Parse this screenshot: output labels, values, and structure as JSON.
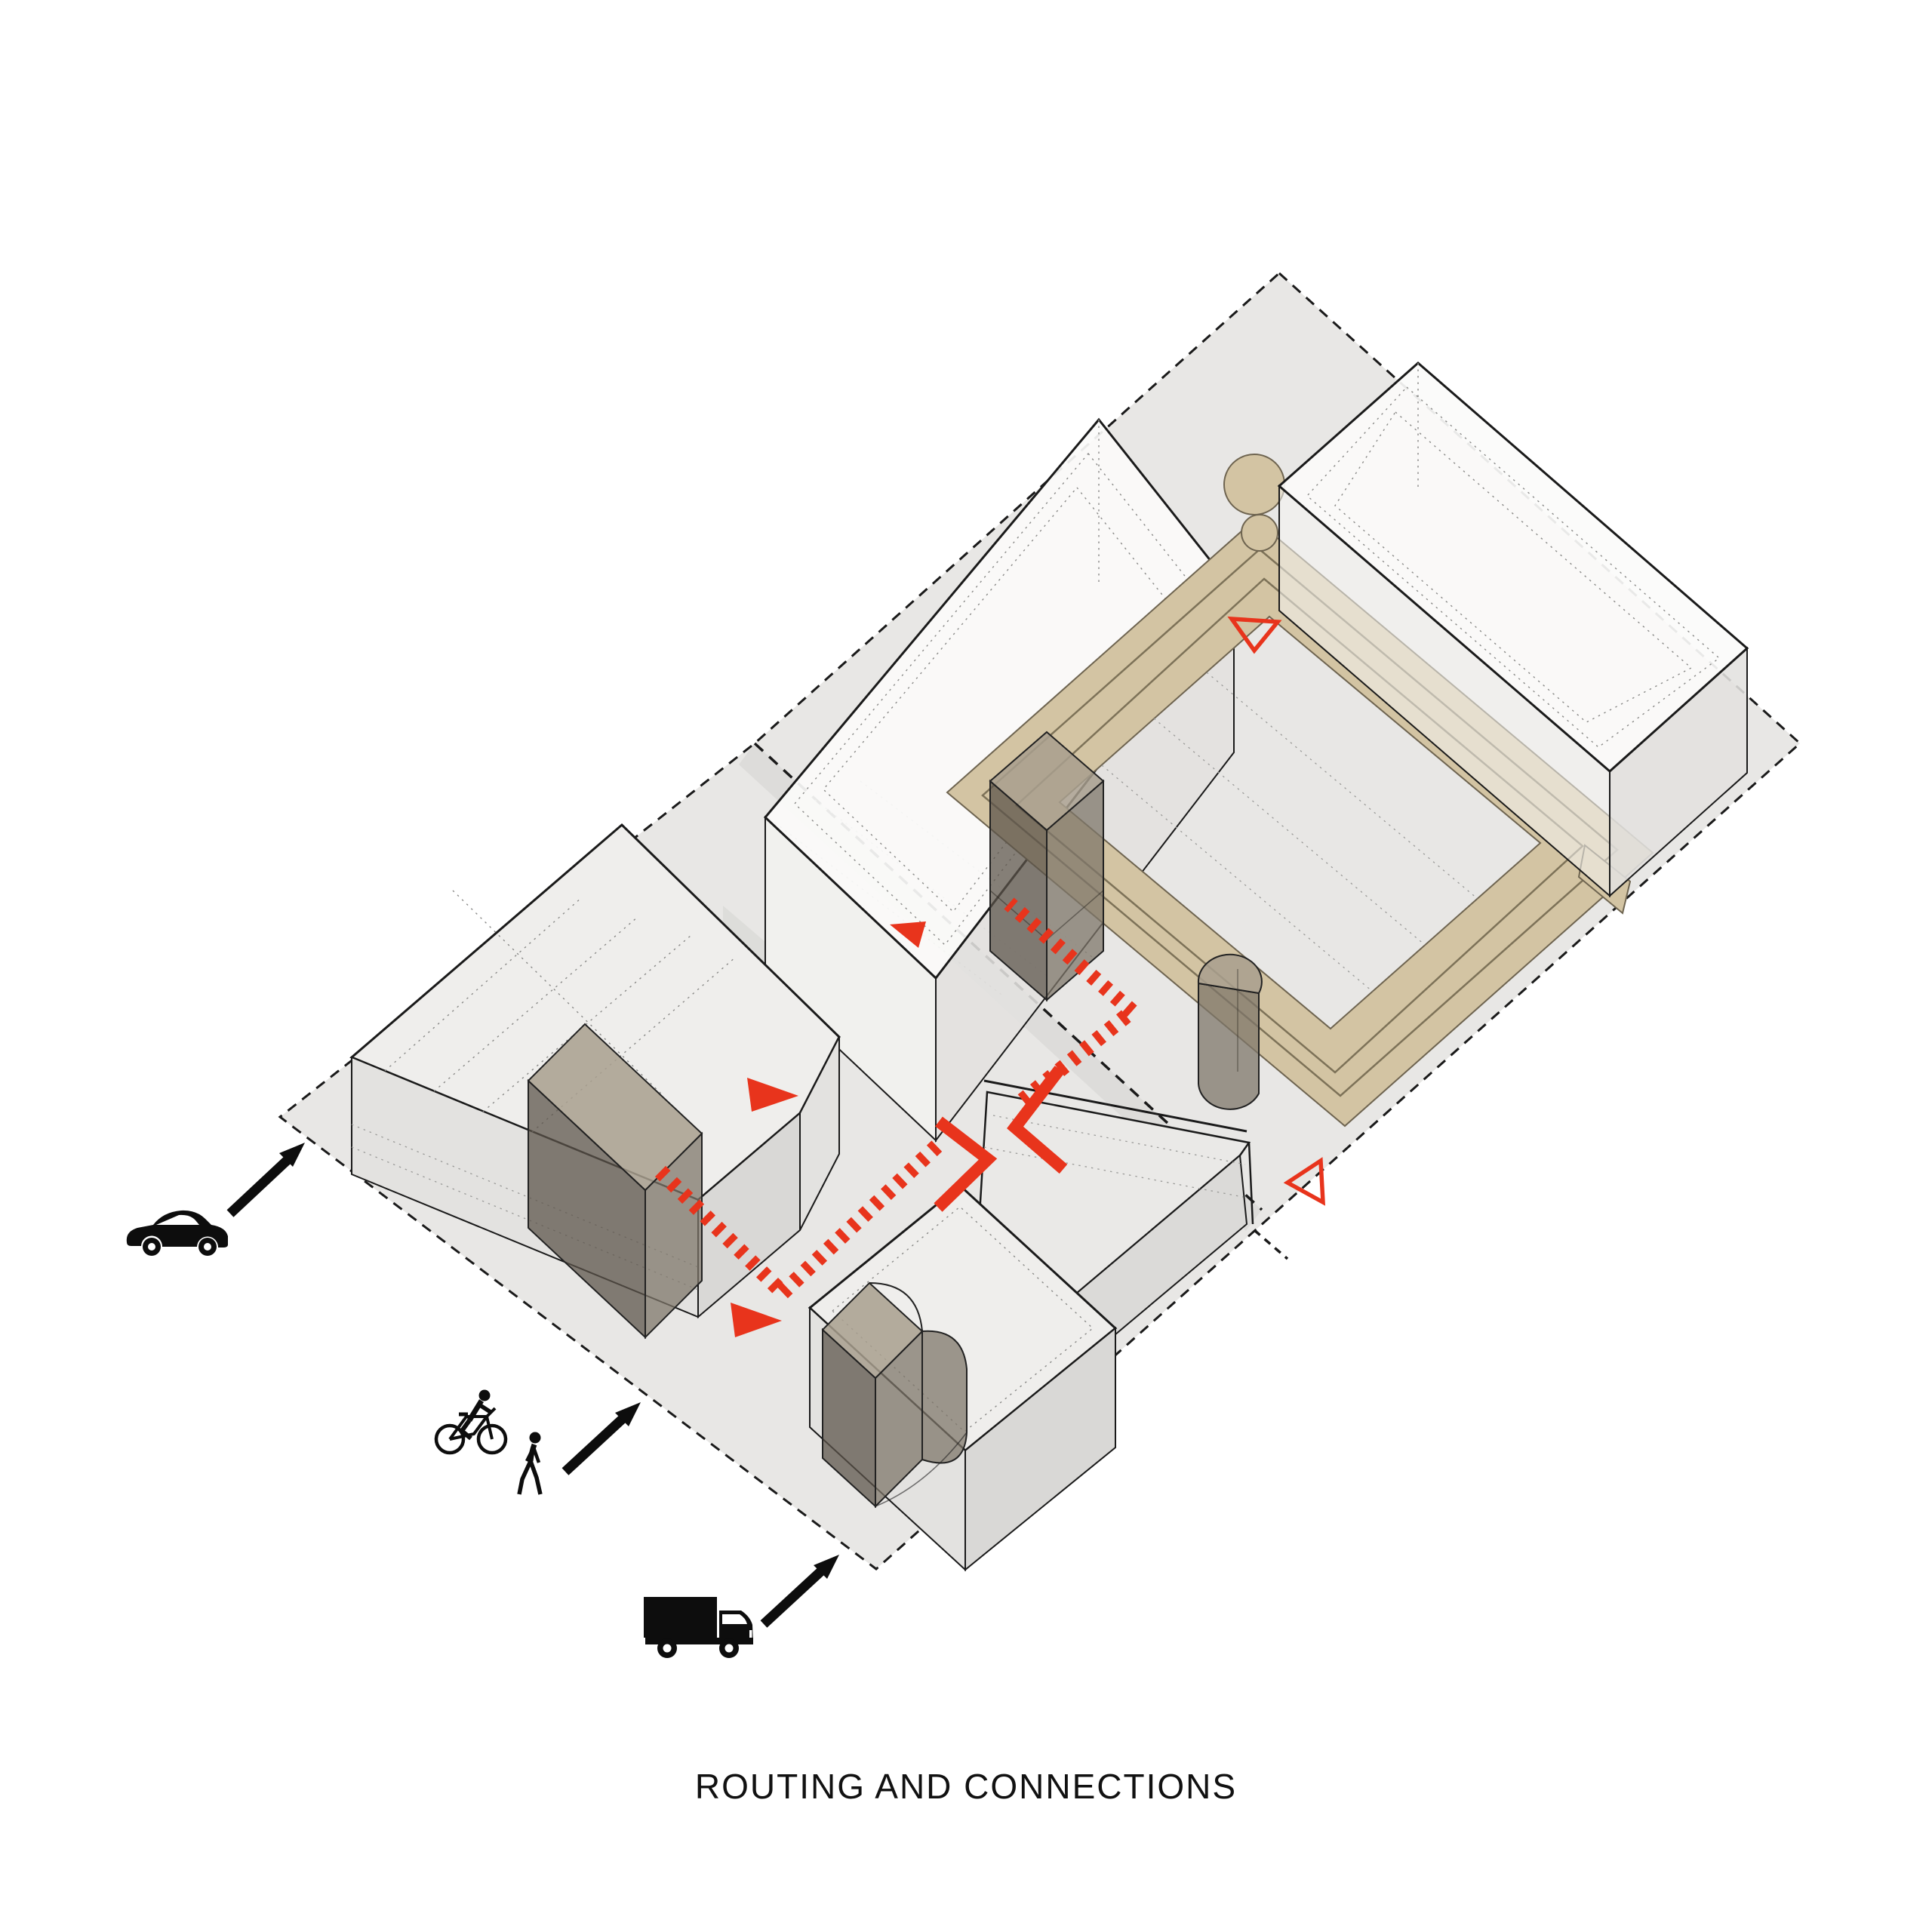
{
  "title": "ROUTING AND CONNECTIONS",
  "colors": {
    "accent_red": "#e8341c",
    "walkway_tan": "#d3c4a3",
    "walkway_edge": "#6e6450",
    "site_gray": "#e8e7e5",
    "line_black": "#1a1a1a",
    "building_white": "#fbfbfa",
    "dark_volume": "#5c544a"
  },
  "access_modes": [
    {
      "id": "car",
      "icon": "car-icon"
    },
    {
      "id": "bicycle",
      "icon": "cyclist-icon"
    },
    {
      "id": "pedestrian",
      "icon": "pedestrian-icon"
    },
    {
      "id": "truck",
      "icon": "truck-icon"
    }
  ],
  "route_markers": {
    "dashed_route_segments": 4,
    "filled_triangle_arrows": 3,
    "hollow_triangle_markers": 2,
    "chevron_arrows": 2,
    "entry_arrows": 3
  }
}
